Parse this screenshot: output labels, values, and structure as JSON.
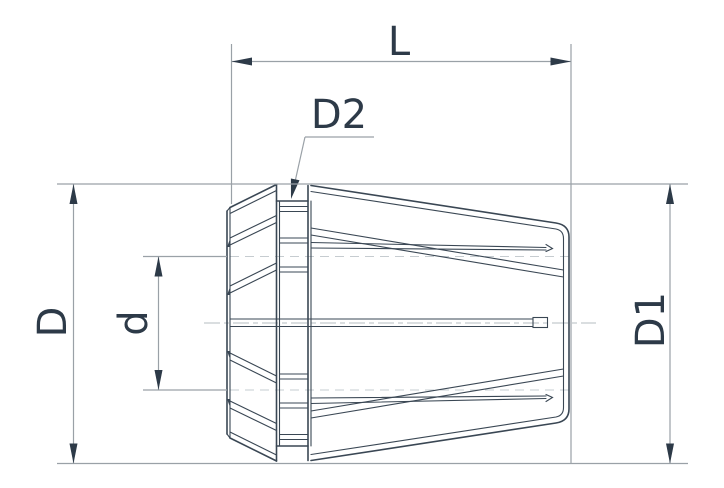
{
  "drawing": {
    "type": "technical-drawing",
    "subject": "ER spring collet side view with dimension callouts",
    "labels": {
      "length": "L",
      "groove_diameter": "D2",
      "outer_diameter": "D",
      "bore_diameter": "d",
      "body_diameter": "D1"
    },
    "colors": {
      "background": "#ffffff",
      "part_outline": "#3a4754",
      "dimension_line": "#9aa1a7",
      "label_text": "#2d3a48",
      "centerline": "#b5bcc2",
      "hidden_line": "#c6ccd0"
    }
  }
}
